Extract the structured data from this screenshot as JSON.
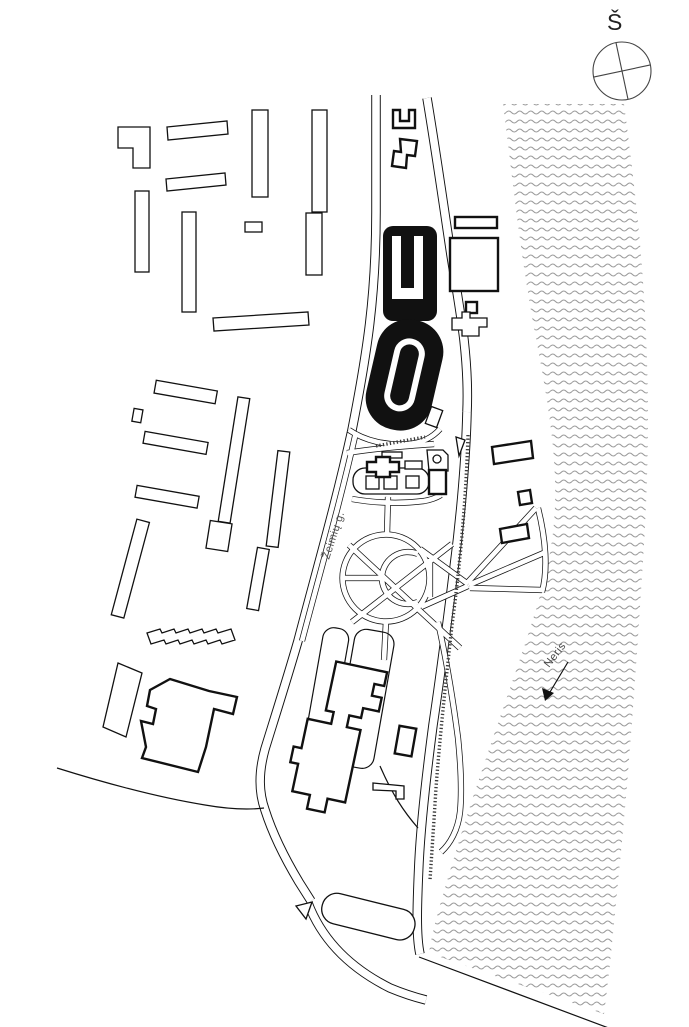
{
  "map": {
    "labels": {
      "north_symbol": "Š",
      "street_name": "Žeimių g.",
      "river_name": "Neris"
    },
    "colors": {
      "ink": "#111111",
      "bold_building_fill": "#111111",
      "river_wave": "#9b9b9b",
      "background": "#ffffff"
    },
    "icons": {
      "compass": "crossed-circle-north-indicator",
      "river_pattern": "wave-hatch",
      "flow_arrow": "downstream-arrow"
    }
  }
}
